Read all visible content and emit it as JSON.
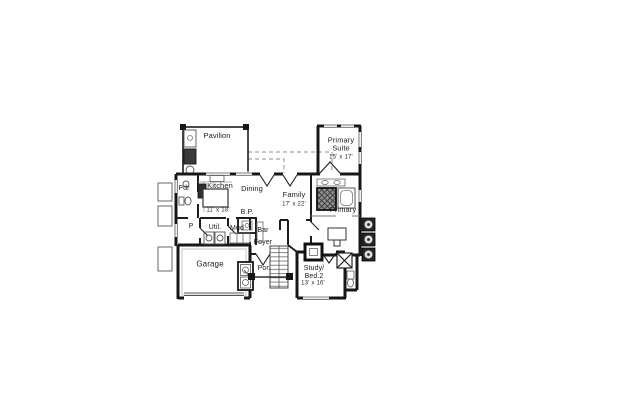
{
  "drawing": {
    "type": "architectural-floor-plan",
    "colors": {
      "background": "#ffffff",
      "walls": "#171717",
      "fixture_lines": "#666666",
      "dark_fill": "#333333"
    },
    "rooms": {
      "pavilion": {
        "label": "Pavilion"
      },
      "primary_suite": {
        "label": "Primary\nSuite",
        "dims": "15' x 17'"
      },
      "pdr": {
        "label": "Pdr"
      },
      "kitchen": {
        "label": "Kitchen",
        "dims": "11' x 18'"
      },
      "dining": {
        "label": "Dining"
      },
      "family": {
        "label": "Family",
        "dims": "17' x 22'"
      },
      "primary_bath": {
        "label": "Primary"
      },
      "butlers_pantry": {
        "label": "B.P."
      },
      "pantry": {
        "label": "P"
      },
      "utility": {
        "label": "Util."
      },
      "mud": {
        "label": "Mud"
      },
      "bar": {
        "label": "Bar"
      },
      "foyer": {
        "label": "Foyer"
      },
      "garage": {
        "label": "Garage"
      },
      "porch": {
        "label": "Por."
      },
      "study": {
        "label": "Study/\nBed.2",
        "dims": "13' x 16'"
      }
    }
  }
}
